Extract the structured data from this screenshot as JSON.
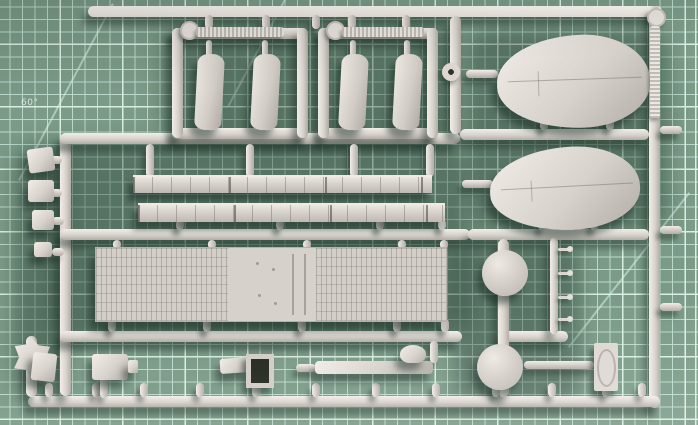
{
  "scene": {
    "type": "photograph",
    "subject": "grey plastic model-kit sprue on a green cutting mat"
  },
  "mat": {
    "angle_label": "60°"
  },
  "sprue": {
    "frame_tab_label": "2",
    "parts": {
      "pontoon_halves": 2,
      "curved_blades": 4,
      "textured_deck_plates": 1,
      "segmented_strips": 2,
      "round_discs": 2,
      "ring_grommets": 1,
      "logo_tags": 1,
      "small_fittings_left_column": 5,
      "small_fittings_bottom_row": 6
    }
  },
  "colors": {
    "mat_base": "#7b9a87",
    "grid_minor": "#b9d9cc",
    "grid_major": "#d9efe4",
    "plastic": "#d7d2cc",
    "plastic_hi": "#f2ede8",
    "plastic_dark": "#b3aca6",
    "tab_text": "#8d867f"
  }
}
